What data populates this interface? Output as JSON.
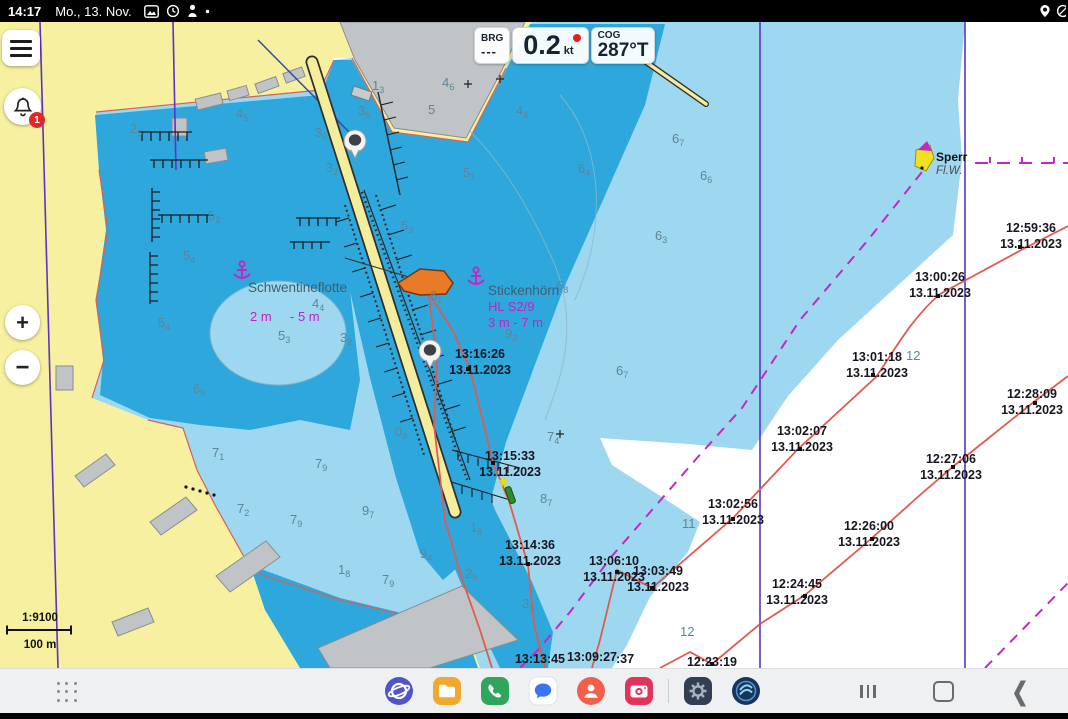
{
  "status_bar": {
    "time": "14:17",
    "date": "Mo., 13. Nov."
  },
  "instrument_panel": {
    "brg_label": "BRG",
    "brg_value": "---",
    "sog_value": "0.2",
    "sog_unit": "kt",
    "cog_label": "COG",
    "cog_value": "287°T"
  },
  "side_controls": {
    "alert_badge": "1",
    "zoom_in": "+",
    "zoom_out": "−"
  },
  "scale_bar": {
    "ratio": "1:9100",
    "distance": "100 m"
  },
  "chart": {
    "labels": [
      {
        "text": "Schwentineflotte",
        "x": 248,
        "y": 292,
        "cls": "place"
      },
      {
        "text": "Stickenhörn",
        "x": 488,
        "y": 295,
        "cls": "place"
      },
      {
        "text": "2 m",
        "x": 250,
        "y": 321,
        "cls": "mag"
      },
      {
        "text": "- 5 m",
        "x": 290,
        "y": 321,
        "cls": "mag"
      },
      {
        "text": "HL S2/9",
        "x": 488,
        "y": 311,
        "cls": "mag"
      },
      {
        "text": "3 m  - 7 m",
        "x": 488,
        "y": 327,
        "cls": "mag"
      },
      {
        "text": "Sperr",
        "x": 936,
        "y": 161,
        "cls": "lblb"
      },
      {
        "text": "Fl.W.",
        "x": 936,
        "y": 174,
        "cls": "lbli"
      }
    ],
    "track_points": [
      {
        "t": "13:16:26",
        "d": "13.11.2023",
        "x": 480,
        "y": 358,
        "dx": 468,
        "dy": 369
      },
      {
        "t": "13:15:33",
        "d": "13.11.2023",
        "x": 510,
        "y": 460,
        "dx": 493,
        "dy": 463
      },
      {
        "t": "13:14:36",
        "d": "13.11.2023",
        "x": 530,
        "y": 549,
        "dx": 528,
        "dy": 564
      },
      {
        "t": "13:13:45",
        "d": "",
        "x": 540,
        "y": 663,
        "dx": 543,
        "dy": 671
      },
      {
        "t": "13:09:27",
        "d": "",
        "x": 592,
        "y": 661,
        "dx": 600,
        "dy": 671
      },
      {
        "t": ":37",
        "d": "",
        "x": 625,
        "y": 663,
        "dx": 0,
        "dy": 0
      },
      {
        "t": "13:06:10",
        "d": "13.11.2023",
        "x": 614,
        "y": 565,
        "dx": 617,
        "dy": 572
      },
      {
        "t": "13:03:49",
        "d": "13.11.2023",
        "x": 658,
        "y": 575,
        "dx": 652,
        "dy": 588
      },
      {
        "t": "13:02:56",
        "d": "13.11.2023",
        "x": 733,
        "y": 508,
        "dx": 733,
        "dy": 519
      },
      {
        "t": "13:02:07",
        "d": "13.11.2023",
        "x": 802,
        "y": 435,
        "dx": 800,
        "dy": 449
      },
      {
        "t": "13:01:18",
        "d": "13.11.2023",
        "x": 877,
        "y": 361,
        "dx": 873,
        "dy": 375
      },
      {
        "t": "13:00:26",
        "d": "13.11.2023",
        "x": 940,
        "y": 281,
        "dx": 938,
        "dy": 296
      },
      {
        "t": "12:59:36",
        "d": "13.11.2023",
        "x": 1031,
        "y": 232,
        "dx": 1020,
        "dy": 247
      },
      {
        "t": "12:28:09",
        "d": "13.11.2023",
        "x": 1032,
        "y": 398,
        "dx": 1035,
        "dy": 403
      },
      {
        "t": "12:27:06",
        "d": "13.11.2023",
        "x": 951,
        "y": 463,
        "dx": 953,
        "dy": 467
      },
      {
        "t": "12:26:00",
        "d": "13.11.2023",
        "x": 869,
        "y": 530,
        "dx": 872,
        "dy": 539
      },
      {
        "t": "12:24:45",
        "d": "13.11.2023",
        "x": 797,
        "y": 588,
        "dx": 805,
        "dy": 596
      },
      {
        "t": "12:23:19",
        "d": "",
        "x": 712,
        "y": 666,
        "dx": 712,
        "dy": 664
      }
    ],
    "depths": [
      {
        "v": "2",
        "s": "5",
        "x": 130,
        "y": 133
      },
      {
        "v": "4",
        "s": "5",
        "x": 236,
        "y": 118
      },
      {
        "v": "1",
        "s": "3",
        "x": 372,
        "y": 90
      },
      {
        "v": "3",
        "s": "6",
        "x": 358,
        "y": 115
      },
      {
        "v": "3",
        "s": "6",
        "x": 315,
        "y": 137
      },
      {
        "v": "3",
        "s": "2",
        "x": 326,
        "y": 172
      },
      {
        "v": "4",
        "s": "6",
        "x": 442,
        "y": 87
      },
      {
        "v": "5",
        "s": "",
        "x": 428,
        "y": 114
      },
      {
        "v": "4",
        "s": "4",
        "x": 516,
        "y": 115
      },
      {
        "v": "5",
        "s": "1",
        "x": 463,
        "y": 177
      },
      {
        "v": "6",
        "s": "4",
        "x": 578,
        "y": 173
      },
      {
        "v": "6",
        "s": "7",
        "x": 672,
        "y": 143
      },
      {
        "v": "6",
        "s": "6",
        "x": 700,
        "y": 180
      },
      {
        "v": "5",
        "s": "2",
        "x": 208,
        "y": 220
      },
      {
        "v": "5",
        "s": "4",
        "x": 183,
        "y": 260
      },
      {
        "v": "6",
        "s": "3",
        "x": 655,
        "y": 240
      },
      {
        "v": "5",
        "s": "3",
        "x": 401,
        "y": 230
      },
      {
        "v": "4",
        "s": "4",
        "x": 312,
        "y": 308
      },
      {
        "v": "6",
        "s": "1",
        "x": 430,
        "y": 300
      },
      {
        "v": "9",
        "s": "2",
        "x": 505,
        "y": 338
      },
      {
        "v": "6",
        "s": "8",
        "x": 556,
        "y": 290
      },
      {
        "v": "5",
        "s": "4",
        "x": 158,
        "y": 327
      },
      {
        "v": "5",
        "s": "3",
        "x": 278,
        "y": 340
      },
      {
        "v": "3",
        "s": "2",
        "x": 340,
        "y": 342
      },
      {
        "v": "6",
        "s": "7",
        "x": 616,
        "y": 375
      },
      {
        "v": "6",
        "s": "9",
        "x": 193,
        "y": 393
      },
      {
        "v": "7",
        "s": "1",
        "x": 212,
        "y": 457
      },
      {
        "v": "7",
        "s": "9",
        "x": 315,
        "y": 468
      },
      {
        "v": "7",
        "s": "2",
        "x": 237,
        "y": 513
      },
      {
        "v": "7",
        "s": "9",
        "x": 290,
        "y": 524
      },
      {
        "v": "9",
        "s": "7",
        "x": 362,
        "y": 515
      },
      {
        "v": "0",
        "s": "8",
        "x": 395,
        "y": 436
      },
      {
        "v": "9",
        "s": "4",
        "x": 420,
        "y": 558
      },
      {
        "v": "7",
        "s": "9",
        "x": 382,
        "y": 584
      },
      {
        "v": "1",
        "s": "8",
        "x": 338,
        "y": 574
      },
      {
        "v": "7",
        "s": "4",
        "x": 547,
        "y": 441
      },
      {
        "v": "8",
        "s": "7",
        "x": 540,
        "y": 503
      },
      {
        "v": "1",
        "s": "8",
        "x": 470,
        "y": 532
      },
      {
        "v": "2",
        "s": "9",
        "x": 465,
        "y": 578
      },
      {
        "v": "3",
        "s": "9",
        "x": 522,
        "y": 608
      },
      {
        "v": "11",
        "s": "",
        "x": 682,
        "y": 528
      },
      {
        "v": "12",
        "s": "",
        "x": 680,
        "y": 636
      },
      {
        "v": "12",
        "s": "",
        "x": 906,
        "y": 360
      }
    ]
  },
  "taskbar": {
    "apps": [
      {
        "name": "internet"
      },
      {
        "name": "my-files"
      },
      {
        "name": "phone"
      },
      {
        "name": "messages"
      },
      {
        "name": "contacts"
      },
      {
        "name": "camera"
      },
      {
        "name": "settings"
      },
      {
        "name": "nv-charts"
      }
    ],
    "nav": {
      "recents": "recents",
      "home": "home",
      "back": "back"
    }
  }
}
